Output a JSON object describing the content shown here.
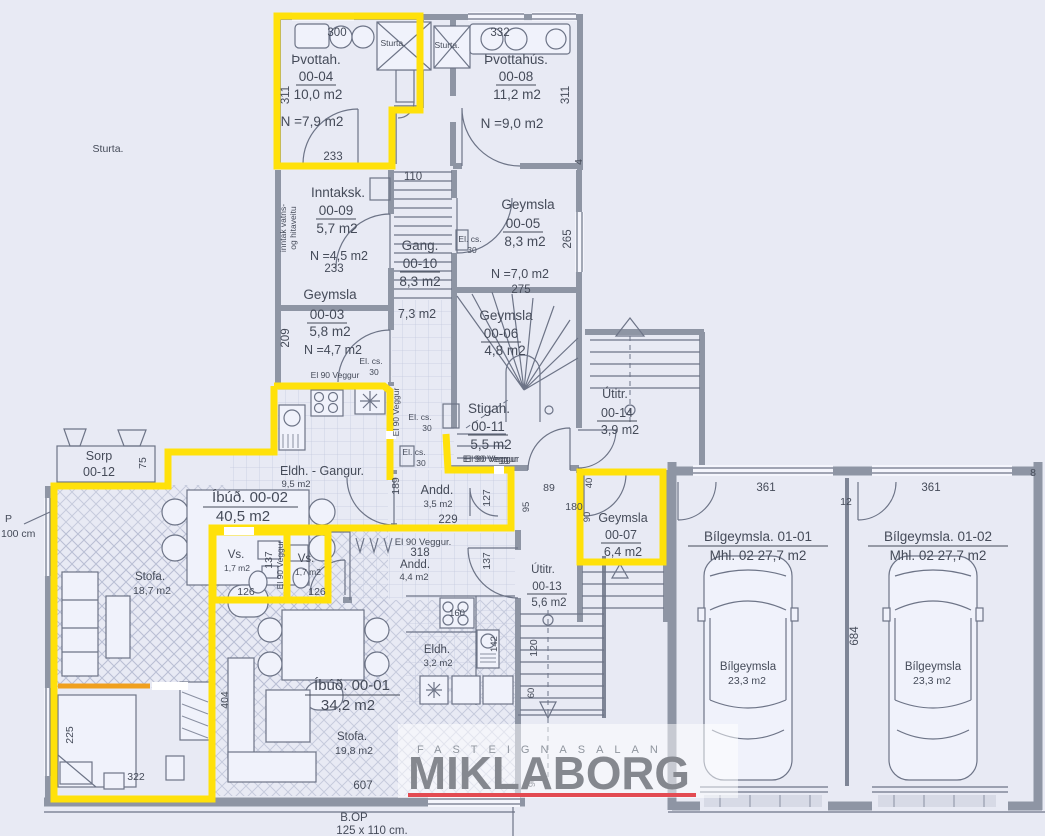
{
  "plan": {
    "rooms": {
      "r04": {
        "name": "Þvottah.",
        "code": "00-04",
        "area": "10,0 m2",
        "net": "N =7,9 m2"
      },
      "r08": {
        "name": "Þvottahús.",
        "code": "00-08",
        "area": "11,2 m2",
        "net": "N =9,0 m2"
      },
      "r09": {
        "name": "Inntaksk.",
        "code": "00-09",
        "area": "5,7 m2",
        "net": "N =4,5 m2"
      },
      "r10": {
        "name": "Gang.",
        "code": "00-10",
        "area": "8,3 m2",
        "area2": "7,3 m2"
      },
      "r05": {
        "name": "Geymsla",
        "code": "00-05",
        "area": "8,3 m2",
        "net": "N =7,0 m2"
      },
      "r03": {
        "name": "Geymsla",
        "code": "00-03",
        "area": "5,8 m2",
        "net": "N =4,7 m2"
      },
      "r06": {
        "name": "Geymsla",
        "code": "00-06",
        "area": "4,8 m2"
      },
      "r11": {
        "name": "Stigah.",
        "code": "00-11",
        "area": "5,5 m2"
      },
      "r14": {
        "name": "Útitr.",
        "code": "00-14",
        "area": "3,9 m2"
      },
      "r12": {
        "name": "Sorp",
        "code": "00-12"
      },
      "r07": {
        "name": "Geymsla",
        "code": "00-07",
        "area": "6,4 m2"
      },
      "r13": {
        "name": "Útitr.",
        "code": "00-13",
        "area": "5,6 m2"
      },
      "eldh_gangur": {
        "name": "Eldh.  -  Gangur.",
        "area": "9,5 m2"
      },
      "apt02": {
        "title": "Íbúð.   00-02",
        "area": "40,5 m2"
      },
      "stofa02": {
        "name": "Stofa.",
        "area": "18,7 m2"
      },
      "vs": {
        "name": "Vs.",
        "area": "1,7 m2"
      },
      "andd35": {
        "name": "Andd.",
        "area": "3,5 m2"
      },
      "andd44": {
        "name": "Andd.",
        "area": "4,4 m2"
      },
      "eldh01": {
        "name": "Eldh.",
        "area": "3,2 m2"
      },
      "apt01": {
        "title": "Íbúð.   00-01",
        "area": "34,2 m2"
      },
      "stofa01": {
        "name": "Stofa.",
        "area": "19,8 m2"
      },
      "gar01": {
        "title": "Bílgeymsla. 01-01",
        "sub": "Mhl. 02   27,7 m2",
        "inner": "Bílgeymsla",
        "inner_area": "23,3 m2"
      },
      "gar02": {
        "title": "Bílgeymsla. 01-02",
        "sub": "Mhl. 02   27,7 m2",
        "inner": "Bílgeymsla",
        "inner_area": "23,3 m2"
      }
    },
    "notes": {
      "sturta": "Sturta.",
      "el_cs": "El. cs.",
      "el30": "30",
      "el90": "El 90 Veggur",
      "el90_dot": "El 90  Veggur.",
      "intake1": "inntak vatns-",
      "intake2": "og hitaveitu",
      "bop": "B.OP",
      "bop_size": "125 x 110 cm.",
      "p": "P",
      "p_size": "100 cm"
    },
    "dims": {
      "d300": "300",
      "d332": "332",
      "d311": "311",
      "d4": "4",
      "d110": "110",
      "d233": "233",
      "d275": "275",
      "d265": "265",
      "d209": "209",
      "d75": "75",
      "d189": "189",
      "d180": "180",
      "d229": "229",
      "d127": "127",
      "d137": "137",
      "d126": "126",
      "d318": "318",
      "d89": "89",
      "d95": "95",
      "d40": "40",
      "d90": "90",
      "d361": "361",
      "d12": "12",
      "d8": "8",
      "d684": "684",
      "d404": "404",
      "d225": "225",
      "d322": "322",
      "d607": "607",
      "d120": "120",
      "d142": "142",
      "d60": "60",
      "d160": "160"
    }
  },
  "brand": {
    "tagline": "FASTEIGNASALAN",
    "name": "MIKLABORG"
  },
  "colors": {
    "highlight": "#ffe10a",
    "wall": "#8e95a4",
    "line": "#6d7487",
    "text": "#454b59",
    "brand_red": "#e34b52",
    "brand_gray": "#85888f",
    "orange": "#f0a01e",
    "background": "#e8eaf4"
  }
}
